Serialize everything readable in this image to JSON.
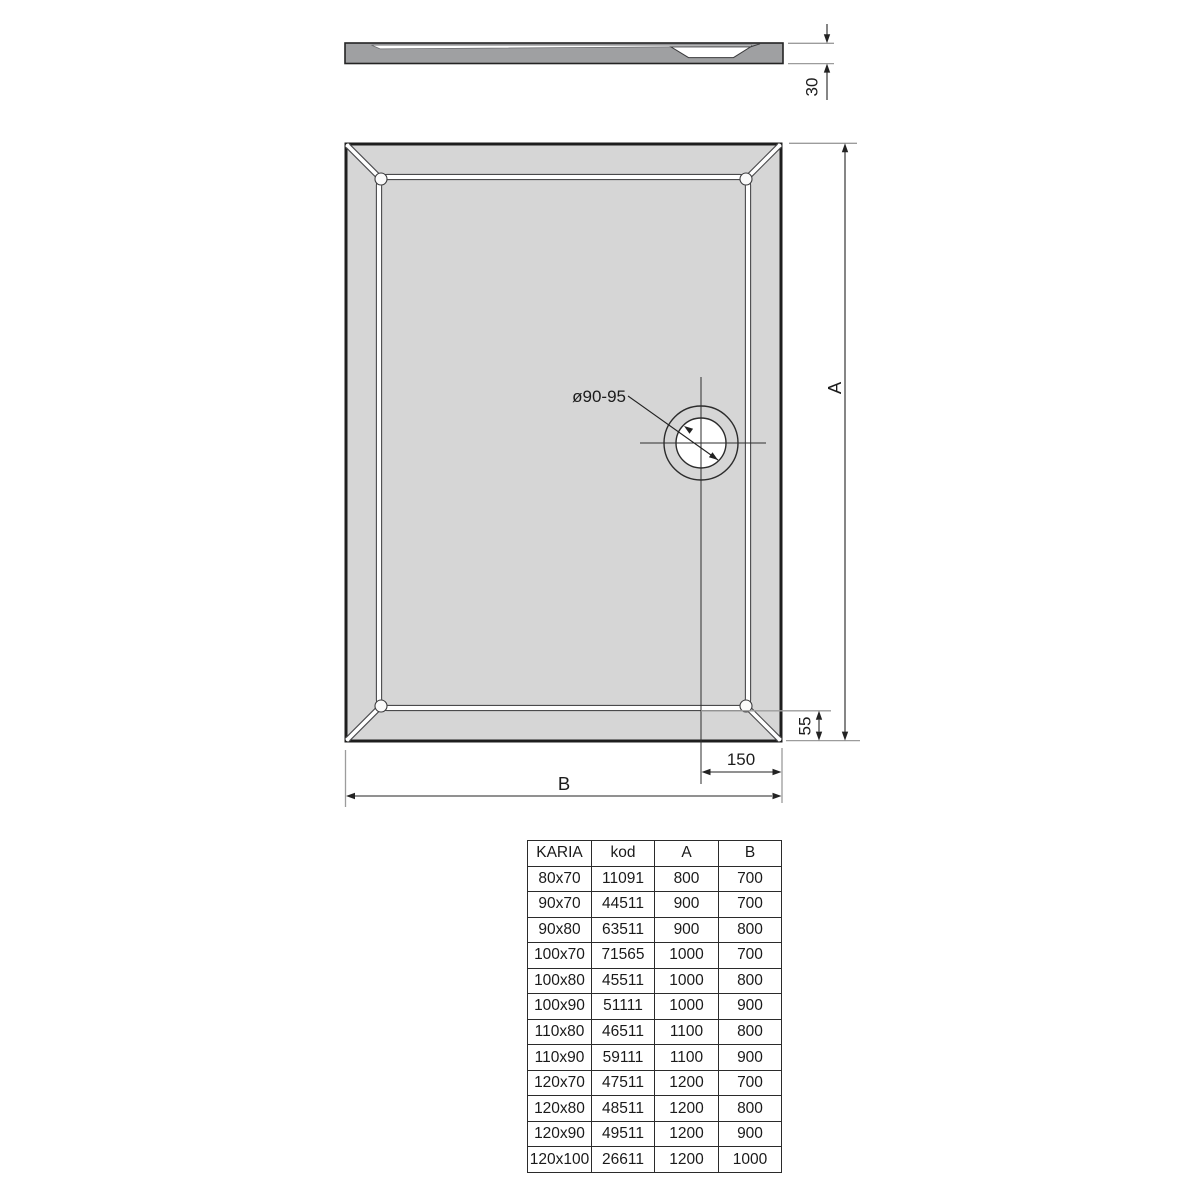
{
  "drawing": {
    "side_view": {
      "thickness_dim": "30"
    },
    "plan_view": {
      "drain_label": "ø90-95",
      "height_dim": "A",
      "width_dim": "B",
      "drain_edge_dim": "55",
      "drain_offset_dim": "150"
    }
  },
  "table": {
    "headers": [
      "KARIA",
      "kod",
      "A",
      "B"
    ],
    "rows": [
      {
        "size": "80x70",
        "kod": "11091",
        "a": "800",
        "b": "700"
      },
      {
        "size": "90x70",
        "kod": "44511",
        "a": "900",
        "b": "700"
      },
      {
        "size": "90x80",
        "kod": "63511",
        "a": "900",
        "b": "800"
      },
      {
        "size": "100x70",
        "kod": "71565",
        "a": "1000",
        "b": "700"
      },
      {
        "size": "100x80",
        "kod": "45511",
        "a": "1000",
        "b": "800"
      },
      {
        "size": "100x90",
        "kod": "51111",
        "a": "1000",
        "b": "900"
      },
      {
        "size": "110x80",
        "kod": "46511",
        "a": "1100",
        "b": "800"
      },
      {
        "size": "110x90",
        "kod": "59111",
        "a": "1100",
        "b": "900"
      },
      {
        "size": "120x70",
        "kod": "47511",
        "a": "1200",
        "b": "700"
      },
      {
        "size": "120x80",
        "kod": "48511",
        "a": "1200",
        "b": "800"
      },
      {
        "size": "120x90",
        "kod": "49511",
        "a": "1200",
        "b": "900"
      },
      {
        "size": "120x100",
        "kod": "26611",
        "a": "1200",
        "b": "1000"
      }
    ]
  },
  "colors": {
    "tray_fill": "#d6d6d6",
    "section_fill": "#9fa0a2",
    "line_dark": "#232323",
    "line_light": "#9c9c9c"
  }
}
